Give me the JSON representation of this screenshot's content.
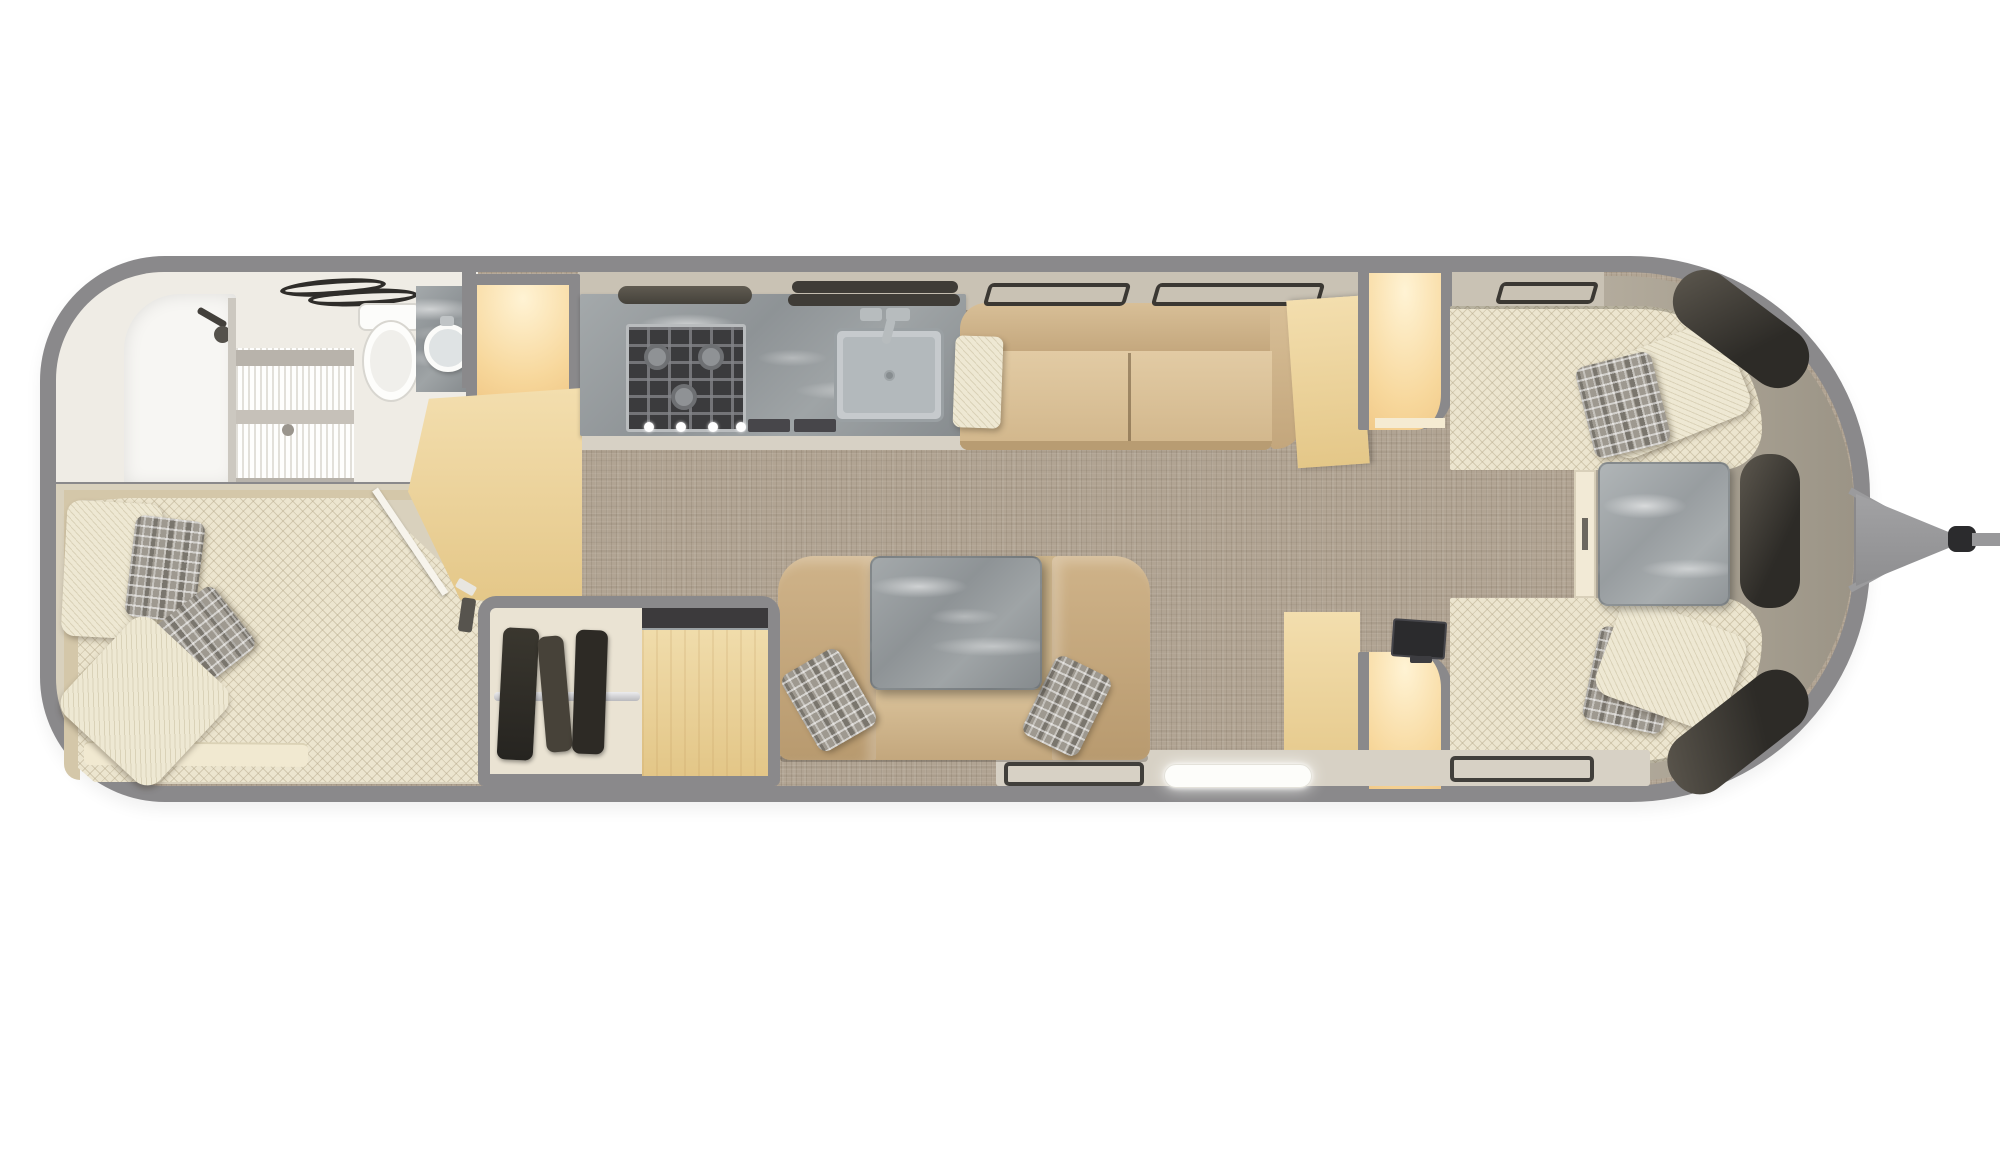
{
  "app": {
    "name": "travel-trailer-floor-plan",
    "view": "top-down 3d rendered floorplan",
    "text_content": "none (image contains no visible text)"
  },
  "canvas": {
    "width": 2000,
    "height": 1152,
    "background": "#ffffff"
  },
  "palette": {
    "shell": "#8a898b",
    "carpet": "#b1a493",
    "hardFloor": "#d7d1c5",
    "tanFloor": "#d9d1bd",
    "band": "#c9c2b4",
    "liner": "#aca293",
    "wood": "#eed9a6",
    "woodLit": "#ffe9c2",
    "marble": "#969b9e",
    "marbleLight": "#a9aeb1",
    "leather": "#d2b88f",
    "cream": "#eee8d3",
    "quilt": "#ece5cf",
    "plaid": "#9e9990",
    "white": "#f7f6f3",
    "brownRug": "#9d8e77",
    "steel": "#c6cacd",
    "windowDark": "#3b3833",
    "glow": "#fdfdfa"
  },
  "layout": {
    "orientation": "horizontal",
    "hitch_side": "right",
    "rear_side": "left"
  },
  "rooms": [
    {
      "id": "bathroom",
      "name": "rear bathroom",
      "position": "rear top-left",
      "furniture": [
        "shower stall",
        "frosted shower door",
        "shower head",
        "toilet",
        "round vessel sink on marble counter",
        "two towel bars",
        "woven brown rug"
      ]
    },
    {
      "id": "bedroom",
      "name": "rear bedroom",
      "position": "rear bottom-left",
      "furniture": [
        "double bed with quilted cream bedding",
        "2 cream pillows",
        "2 gray plaid accent pillows",
        "folded blanket",
        "angled wardrobe door with white trim",
        "lit wardrobe niche"
      ]
    },
    {
      "id": "kitchen",
      "name": "galley kitchen",
      "position": "center-top",
      "furniture": [
        "gray marble countertop",
        "3-burner gas range with 4 knobs",
        "range hood bar",
        "stainless square sink with faucet",
        "double awning window bars",
        "two base vents",
        "overhead cabinet band"
      ]
    },
    {
      "id": "living",
      "name": "living area sofa",
      "position": "center-top right of kitchen",
      "furniture": [
        "tan leather sofa with two seat cushions",
        "textured accent pillow",
        "two open awning window outlines",
        "angled maple end cabinet",
        "lit storage niche with rounded gray frame"
      ]
    },
    {
      "id": "dinette",
      "name": "lounge dinette",
      "position": "center-bottom",
      "furniture": [
        "tan leather sofa with curved arms",
        "gray marble pedestal table",
        "2 gray plaid pillows",
        "dark floor mat outline",
        "LED-lit entry step"
      ]
    },
    {
      "id": "closet",
      "name": "wardrobe closet",
      "position": "bottom-center",
      "furniture": [
        "hanging rod with dark garments",
        "maple cabinet top with dark counter strip"
      ]
    },
    {
      "id": "front_lounge",
      "name": "front twin lounge",
      "position": "front right",
      "furniture": [
        "top twin bed with quilted cream fabric",
        "bottom twin bed with quilted cream fabric",
        "2 cream bolster pillows",
        "2 gray plaid pillows",
        "square marble corner table",
        "cream table ledge with latch",
        "flat tv on cabinet",
        "maple nightstand cabinet",
        "2 lit storage niches with rounded gray frames",
        "3 smoked wrap-around front windows",
        "second floor mat outline"
      ]
    },
    {
      "id": "exterior",
      "name": "hitch tongue",
      "position": "far right outside shell",
      "furniture": [
        "a-frame hitch triangle",
        "two hitch struts",
        "dark coupler",
        "tongue bar"
      ]
    }
  ]
}
